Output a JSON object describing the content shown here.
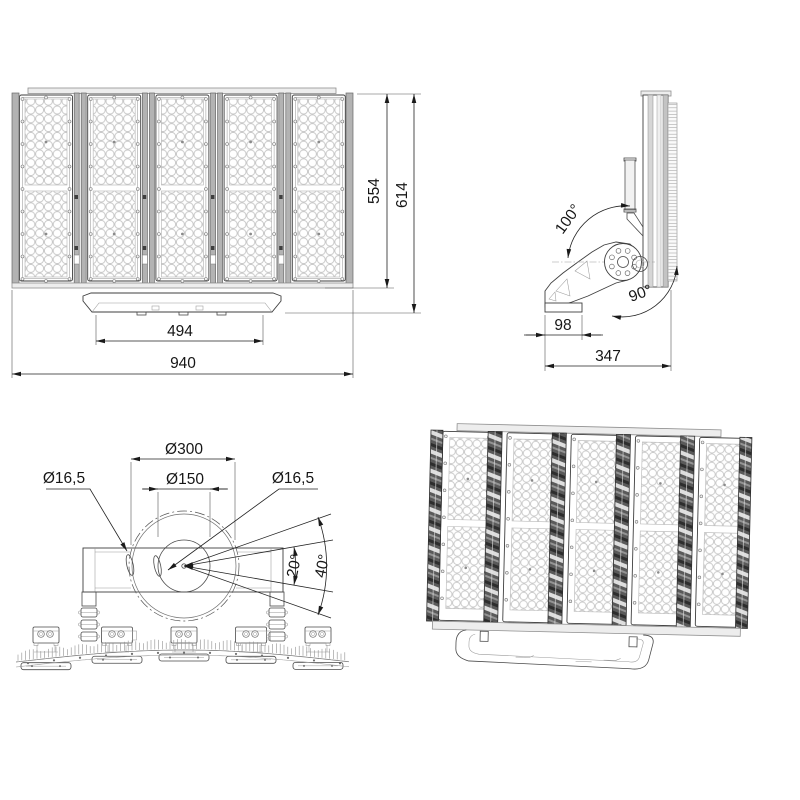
{
  "page": {
    "background": "#ffffff"
  },
  "drawing": {
    "ink": "#1d1d1d",
    "metal_light": "#b3b3b3",
    "metal_dark": "#4f4f4f",
    "front_view": {
      "overall_width": "940",
      "mount_width": "494",
      "body_height": "554",
      "overall_height": "614"
    },
    "side_view": {
      "mount_depth": "98",
      "overall_depth": "347",
      "tilt_rear": "100°",
      "tilt_front": "90°"
    },
    "top_view": {
      "bolt_circle": "Ø300",
      "hub_circle": "Ø150",
      "hole_left": "Ø16,5",
      "hole_right": "Ø16,5",
      "aiming_angle_inner": "20°",
      "aiming_angle_outer": "40°"
    }
  }
}
